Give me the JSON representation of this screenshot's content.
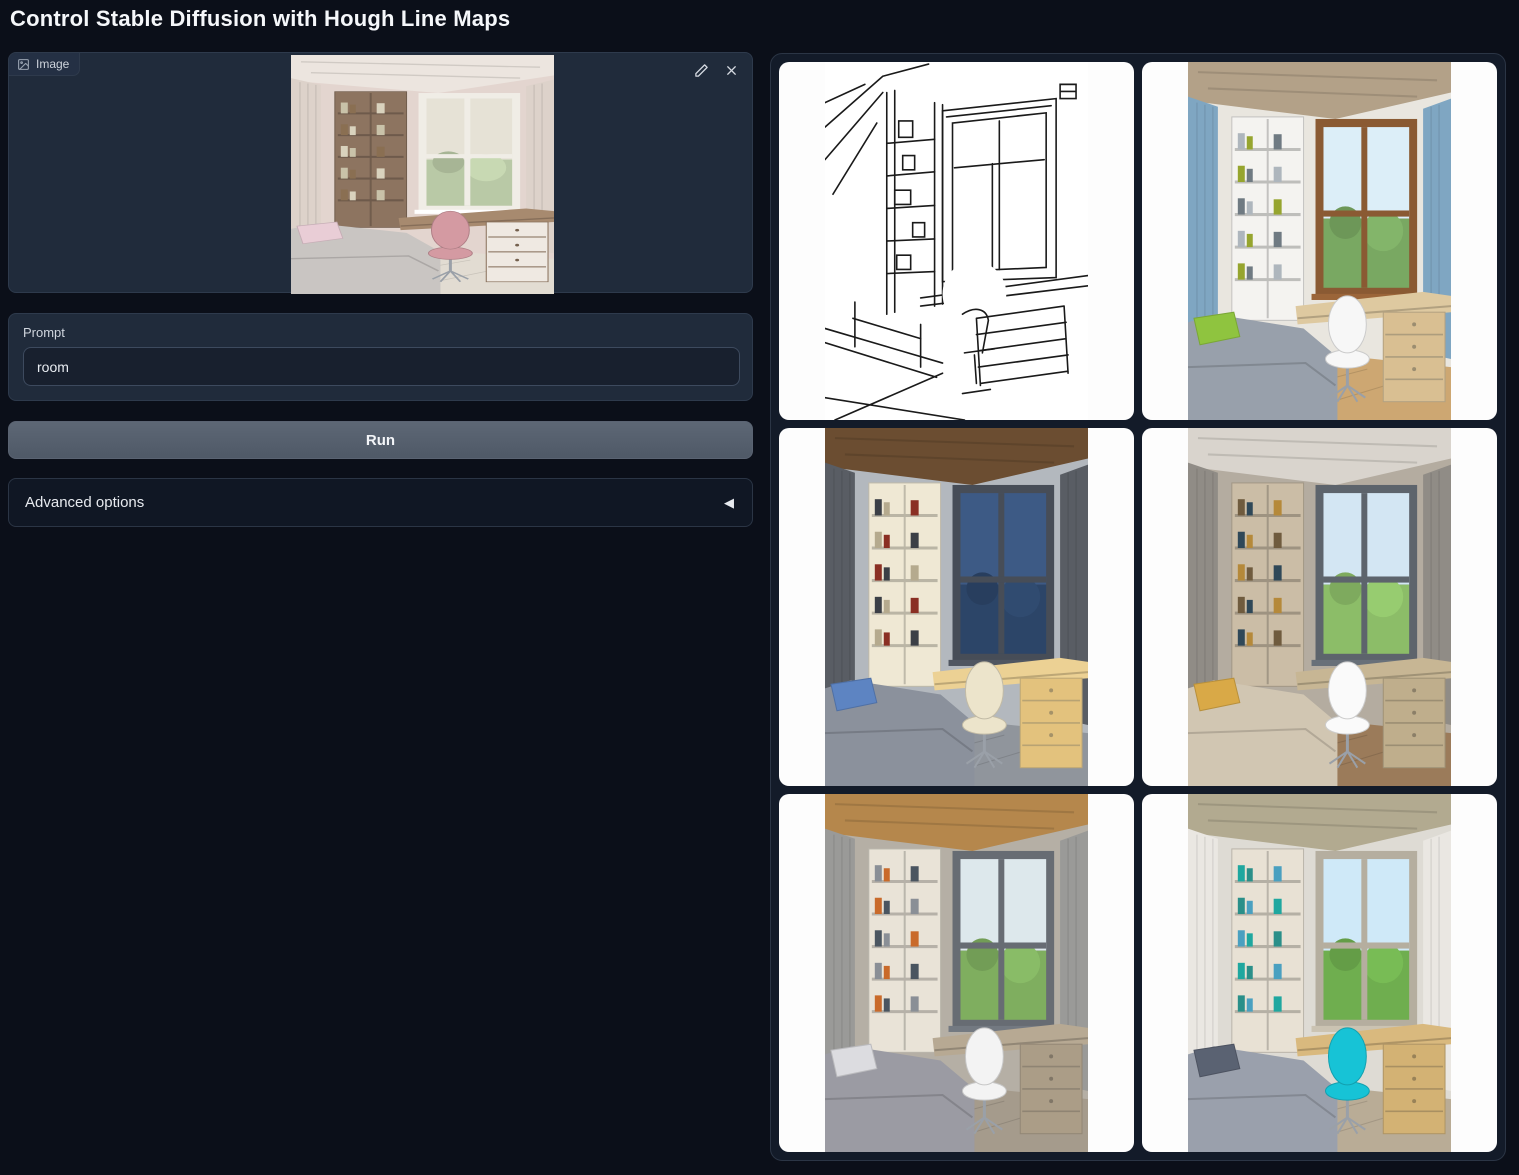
{
  "app": {
    "title": "Control Stable Diffusion with Hough Line Maps"
  },
  "input_panel": {
    "label": "Image",
    "image": {
      "type": "room",
      "alt": "uploaded photo: child's bedroom with wooden bookshelf, desk by the window, pink office chair and grey bed",
      "palette": {
        "wall": "#e3d5cf",
        "ceiling": "#ece5df",
        "curtain": "#ddd2ca",
        "shelf": "#8d7460",
        "frame": "#f0ede6",
        "sky": "#e6e2d6",
        "trees": "#b9c9a6",
        "desk": "#a78a6f",
        "drawers": "#efe9e2",
        "chair": "#d49aa2",
        "bed": "#c9c5c2",
        "pillow": "#e9cdd6",
        "floor": "#e2dcd2",
        "books": [
          "#c9c2a9",
          "#8a6f52",
          "#d9d2bd"
        ]
      }
    }
  },
  "prompt": {
    "label": "Prompt",
    "value": "room"
  },
  "run_button": {
    "label": "Run"
  },
  "advanced": {
    "label": "Advanced options",
    "icon": "◀"
  },
  "gallery": {
    "items": [
      {
        "type": "linemap",
        "alt": "Hough line map extracted from the input room photo: black straight-line sketch of bookshelf, window, desk and bed on white"
      },
      {
        "type": "room",
        "alt": "generated bedroom with blue curtains, white shelving, wooden window frame, green pillow on grey bed and white desk chair",
        "palette": {
          "wall": "#e9e6df",
          "ceiling": "#b3a188",
          "curtain": "#7fa6c2",
          "shelf": "#f4f3f0",
          "frame": "#8a5a33",
          "sky": "#dceef8",
          "trees": "#79a862",
          "desk": "#dec9a0",
          "drawers": "#d9bf92",
          "chair": "#f7f7f7",
          "bed": "#98a0ab",
          "pillow": "#8fc43f",
          "floor": "#cda772",
          "books": [
            "#aeb6bd",
            "#96a52f",
            "#6f7a82"
          ]
        }
      },
      {
        "type": "room",
        "alt": "generated bedroom at dusk with dark grey curtains, cream shelving, warm lit desk, blue pillow and wooden slat ceiling",
        "palette": {
          "wall": "#b3b8be",
          "ceiling": "#6b4d31",
          "curtain": "#595d64",
          "shelf": "#efe8d4",
          "frame": "#474d57",
          "sky": "#3d5a85",
          "trees": "#2c4568",
          "desk": "#ecd194",
          "drawers": "#e3c27d",
          "chair": "#ece4cb",
          "bed": "#8b919c",
          "pillow": "#5d84c2",
          "floor": "#90959c",
          "books": [
            "#3b3f46",
            "#b5aa8e",
            "#8a2f23"
          ]
        }
      },
      {
        "type": "room",
        "alt": "generated beige bedroom with taupe walls, mustard pillow, white desk chair, wood floor and garden view",
        "palette": {
          "wall": "#b4aca0",
          "ceiling": "#d9d4cd",
          "curtain": "#908c86",
          "shelf": "#cbbda6",
          "frame": "#5d646c",
          "sky": "#d3e6f3",
          "trees": "#8cbd68",
          "desk": "#c7b694",
          "drawers": "#bfae8c",
          "chair": "#fafafa",
          "bed": "#d1c6b2",
          "pillow": "#d9a947",
          "floor": "#9b7b5a",
          "books": [
            "#6f5b3e",
            "#2f4858",
            "#b5893a"
          ]
        }
      },
      {
        "type": "room",
        "alt": "generated bedroom with wooden plank ceiling, grey curtains, patterned grey bedding and white swivel chair",
        "palette": {
          "wall": "#b5afa5",
          "ceiling": "#b5874c",
          "curtain": "#9a9a98",
          "shelf": "#e9e3d7",
          "frame": "#676c73",
          "sky": "#dde8ec",
          "trees": "#7fae5f",
          "desk": "#b7a993",
          "drawers": "#ab9d87",
          "chair": "#f3f3f3",
          "bed": "#9b9ba3",
          "pillow": "#dcdce0",
          "floor": "#a59b8c",
          "books": [
            "#8a8f96",
            "#c96a2a",
            "#4a5560"
          ]
        }
      },
      {
        "type": "room",
        "alt": "generated bright bedroom with cyan designer desk chair, teal books on pale shelving and big sunny window",
        "palette": {
          "wall": "#dedbd4",
          "ceiling": "#b2aa90",
          "curtain": "#eae7e2",
          "shelf": "#e8e1d4",
          "frame": "#b5ae9f",
          "sky": "#cfe9f8",
          "trees": "#6fae4f",
          "desk": "#d9b97e",
          "drawers": "#d3b274",
          "chair": "#17c3d6",
          "bed": "#9aa0ac",
          "pillow": "#5a6272",
          "floor": "#b9ac96",
          "books": [
            "#1fa79f",
            "#2a8f89",
            "#4aa0c0"
          ]
        }
      }
    ]
  }
}
